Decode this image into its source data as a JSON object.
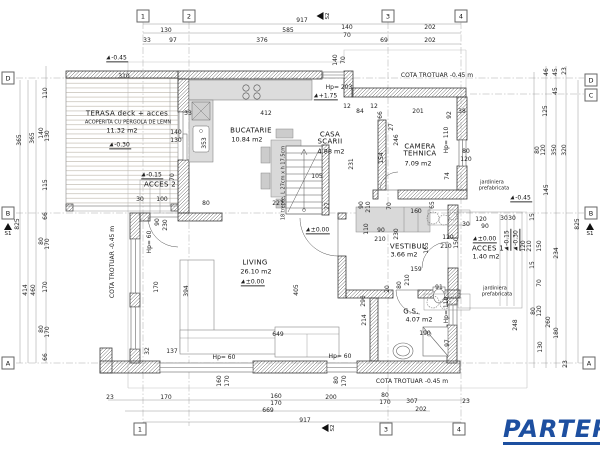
{
  "logo": {
    "text": "PARTER",
    "color": "#1d4fa0"
  },
  "plan": {
    "grid_bubbles": [
      {
        "t": "1",
        "x": 143,
        "y": 16
      },
      {
        "t": "2",
        "x": 189,
        "y": 16
      },
      {
        "t": "3",
        "x": 388,
        "y": 16
      },
      {
        "t": "4",
        "x": 461,
        "y": 16
      },
      {
        "t": "1",
        "x": 140,
        "y": 429
      },
      {
        "t": "3",
        "x": 386,
        "y": 429
      },
      {
        "t": "4",
        "x": 459,
        "y": 429
      },
      {
        "t": "D",
        "x": 8,
        "y": 78
      },
      {
        "t": "B",
        "x": 8,
        "y": 213
      },
      {
        "t": "A",
        "x": 8,
        "y": 363
      },
      {
        "t": "D",
        "x": 591,
        "y": 80
      },
      {
        "t": "C",
        "x": 591,
        "y": 95
      },
      {
        "t": "B",
        "x": 591,
        "y": 213
      },
      {
        "t": "A",
        "x": 589,
        "y": 363
      }
    ],
    "section_markers": [
      {
        "t": "S2",
        "x": 324,
        "y": 16,
        "dir": "left"
      },
      {
        "t": "S2",
        "x": 329,
        "y": 428,
        "dir": "left"
      },
      {
        "t": "S1",
        "x": 8,
        "y": 230,
        "dir": "up"
      },
      {
        "t": "S1",
        "x": 590,
        "y": 230,
        "dir": "up"
      }
    ],
    "rooms": [
      {
        "name": "TERASA deck + acces",
        "nx": 127,
        "ny": 114,
        "sub": "ACOPERITA CU PERGOLA DE LEMN",
        "sx": 128,
        "sy": 123,
        "area": "11.32 m2",
        "ax": 122,
        "ay": 131
      },
      {
        "name": "BUCATARIE",
        "nx": 251,
        "ny": 131,
        "area": "10.84 m2",
        "ax": 247,
        "ay": 140
      },
      {
        "name": "CASA SCARII",
        "nx": 330,
        "ny": 139,
        "nw": 36,
        "area": "4.88 m2",
        "ax": 331,
        "ay": 152
      },
      {
        "name": "CAMERA TEHNICA",
        "nx": 420,
        "ny": 151,
        "nw": 54,
        "area": "7.09 m2",
        "ax": 418,
        "ay": 164
      },
      {
        "name": "VESTIBUL",
        "nx": 408,
        "ny": 247,
        "area": "3.66 m2",
        "ax": 404,
        "ay": 255
      },
      {
        "name": "ACCES 1",
        "nx": 488,
        "ny": 249,
        "area": "1.40 m2",
        "ax": 486,
        "ay": 257
      },
      {
        "name": "ACCES 2",
        "nx": 160,
        "ny": 185
      },
      {
        "name": "LIVING",
        "nx": 255,
        "ny": 263,
        "area": "26.10 m2",
        "ax": 256,
        "ay": 272
      },
      {
        "name": "G.S.",
        "nx": 411,
        "ny": 312,
        "area": "4.07 m2",
        "ax": 419,
        "ay": 320
      }
    ],
    "levels": [
      {
        "t": "-0.45",
        "x": 117,
        "y": 59
      },
      {
        "t": "-0.30",
        "x": 120,
        "y": 146
      },
      {
        "t": "-0.15",
        "x": 152,
        "y": 176
      },
      {
        "t": "+1.75",
        "x": 326,
        "y": 97
      },
      {
        "t": "±0.00",
        "x": 253,
        "y": 283
      },
      {
        "t": "±0.00",
        "x": 318,
        "y": 231
      },
      {
        "t": "±0.00",
        "x": 485,
        "y": 240
      },
      {
        "t": "-0.45",
        "x": 521,
        "y": 199
      },
      {
        "t": "-0.15",
        "x": 508,
        "y": 240,
        "r": 1
      },
      {
        "t": "-0.30",
        "x": 517,
        "y": 240,
        "r": 1
      }
    ],
    "notes": [
      {
        "t": "COTA TROTUAR -0.45 m",
        "x": 437,
        "y": 76
      },
      {
        "t": "COTA TROTUAR -0.45 m",
        "x": 412,
        "y": 382
      },
      {
        "t": "COTA TROTUAR -0.45 m",
        "x": 113,
        "y": 262,
        "r": 1
      },
      {
        "t": "Hp= 203",
        "x": 339,
        "y": 88
      },
      {
        "t": "Hp= 60",
        "x": 224,
        "y": 358
      },
      {
        "t": "Hp= 60",
        "x": 340,
        "y": 357
      },
      {
        "t": "Hp= 60",
        "x": 150,
        "y": 242,
        "r": 1
      },
      {
        "t": "Hp= 110",
        "x": 447,
        "y": 140,
        "r": 1
      },
      {
        "t": "Hp= 110",
        "x": 447,
        "y": 310,
        "r": 1
      },
      {
        "t": "jardiniera",
        "x": 492,
        "y": 183,
        "small": 1
      },
      {
        "t": "prefabricata",
        "x": 494,
        "y": 189,
        "small": 1
      },
      {
        "t": "jardiniera",
        "x": 495,
        "y": 289,
        "small": 1
      },
      {
        "t": "prefabricata",
        "x": 497,
        "y": 295,
        "small": 1
      },
      {
        "t": "18 trepte, L 27cm x h 17.5cm",
        "x": 284,
        "y": 183,
        "r": 1,
        "small": 1
      }
    ],
    "dimensions": [
      {
        "t": "917",
        "x": 302,
        "y": 21
      },
      {
        "t": "130",
        "x": 166,
        "y": 31
      },
      {
        "t": "585",
        "x": 288,
        "y": 31
      },
      {
        "t": "140",
        "x": 347,
        "y": 28
      },
      {
        "t": "70",
        "x": 347,
        "y": 36
      },
      {
        "t": "202",
        "x": 430,
        "y": 28
      },
      {
        "t": "33",
        "x": 147,
        "y": 41
      },
      {
        "t": "97",
        "x": 173,
        "y": 41
      },
      {
        "t": "376",
        "x": 262,
        "y": 41
      },
      {
        "t": "69",
        "x": 384,
        "y": 41
      },
      {
        "t": "202",
        "x": 430,
        "y": 41
      },
      {
        "t": "140",
        "x": 336,
        "y": 60,
        "r": 1
      },
      {
        "t": "70",
        "x": 344,
        "y": 60,
        "r": 1
      },
      {
        "t": "310",
        "x": 124,
        "y": 77
      },
      {
        "t": "110",
        "x": 46,
        "y": 93,
        "r": 1
      },
      {
        "t": "33",
        "x": 188,
        "y": 114
      },
      {
        "t": "412",
        "x": 266,
        "y": 114
      },
      {
        "t": "84",
        "x": 360,
        "y": 112
      },
      {
        "t": "12",
        "x": 347,
        "y": 107
      },
      {
        "t": "12",
        "x": 374,
        "y": 107
      },
      {
        "t": "66",
        "x": 381,
        "y": 115,
        "r": 1
      },
      {
        "t": "201",
        "x": 418,
        "y": 112
      },
      {
        "t": "92",
        "x": 450,
        "y": 115,
        "r": 1
      },
      {
        "t": "38",
        "x": 462,
        "y": 112
      },
      {
        "t": "27",
        "x": 392,
        "y": 127,
        "r": 1
      },
      {
        "t": "246",
        "x": 397,
        "y": 140,
        "r": 1
      },
      {
        "t": "154",
        "x": 382,
        "y": 158,
        "r": 1
      },
      {
        "t": "74",
        "x": 448,
        "y": 176,
        "r": 1
      },
      {
        "t": "80",
        "x": 466,
        "y": 152
      },
      {
        "t": "120",
        "x": 466,
        "y": 160
      },
      {
        "t": "140",
        "x": 176,
        "y": 133
      },
      {
        "t": "130",
        "x": 176,
        "y": 141
      },
      {
        "t": "353",
        "x": 205,
        "y": 143,
        "r": 1
      },
      {
        "t": "365",
        "x": 20,
        "y": 140,
        "r": 1
      },
      {
        "t": "365",
        "x": 33,
        "y": 138,
        "r": 1
      },
      {
        "t": "140",
        "x": 42,
        "y": 133,
        "r": 1
      },
      {
        "t": "130",
        "x": 48,
        "y": 136,
        "r": 1
      },
      {
        "t": "115",
        "x": 46,
        "y": 185,
        "r": 1
      },
      {
        "t": "66",
        "x": 46,
        "y": 216,
        "r": 1
      },
      {
        "t": "825",
        "x": 18,
        "y": 224,
        "r": 1
      },
      {
        "t": "80",
        "x": 42,
        "y": 241,
        "r": 1
      },
      {
        "t": "170",
        "x": 48,
        "y": 244,
        "r": 1
      },
      {
        "t": "170",
        "x": 46,
        "y": 287,
        "r": 1
      },
      {
        "t": "414",
        "x": 26,
        "y": 290,
        "r": 1
      },
      {
        "t": "460",
        "x": 34,
        "y": 290,
        "r": 1
      },
      {
        "t": "80",
        "x": 42,
        "y": 329,
        "r": 1
      },
      {
        "t": "170",
        "x": 48,
        "y": 332,
        "r": 1
      },
      {
        "t": "66",
        "x": 46,
        "y": 357,
        "r": 1
      },
      {
        "t": "46",
        "x": 547,
        "y": 72,
        "r": 1
      },
      {
        "t": "45",
        "x": 556,
        "y": 72,
        "r": 1
      },
      {
        "t": "23",
        "x": 565,
        "y": 71,
        "r": 1
      },
      {
        "t": "45",
        "x": 556,
        "y": 91,
        "r": 1
      },
      {
        "t": "125",
        "x": 546,
        "y": 111,
        "r": 1
      },
      {
        "t": "80",
        "x": 538,
        "y": 150,
        "r": 1
      },
      {
        "t": "120",
        "x": 544,
        "y": 150,
        "r": 1
      },
      {
        "t": "350",
        "x": 555,
        "y": 150,
        "r": 1
      },
      {
        "t": "320",
        "x": 565,
        "y": 150,
        "r": 1
      },
      {
        "t": "145",
        "x": 547,
        "y": 190,
        "r": 1
      },
      {
        "t": "15",
        "x": 533,
        "y": 217,
        "r": 1
      },
      {
        "t": "825",
        "x": 578,
        "y": 224,
        "r": 1
      },
      {
        "t": "120",
        "x": 524,
        "y": 246,
        "r": 1
      },
      {
        "t": "210",
        "x": 530,
        "y": 246,
        "r": 1
      },
      {
        "t": "150",
        "x": 540,
        "y": 246,
        "r": 1
      },
      {
        "t": "234",
        "x": 557,
        "y": 253,
        "r": 1
      },
      {
        "t": "15",
        "x": 533,
        "y": 265,
        "r": 1
      },
      {
        "t": "70",
        "x": 540,
        "y": 283,
        "r": 1
      },
      {
        "t": "80",
        "x": 534,
        "y": 311,
        "r": 1
      },
      {
        "t": "120",
        "x": 540,
        "y": 311,
        "r": 1
      },
      {
        "t": "260",
        "x": 549,
        "y": 322,
        "r": 1
      },
      {
        "t": "180",
        "x": 557,
        "y": 333,
        "r": 1
      },
      {
        "t": "130",
        "x": 541,
        "y": 347,
        "r": 1
      },
      {
        "t": "23",
        "x": 566,
        "y": 364,
        "r": 1
      },
      {
        "t": "248",
        "x": 516,
        "y": 325,
        "r": 1
      },
      {
        "t": "100",
        "x": 162,
        "y": 200
      },
      {
        "t": "30",
        "x": 140,
        "y": 200
      },
      {
        "t": "80",
        "x": 206,
        "y": 204
      },
      {
        "t": "227",
        "x": 278,
        "y": 204
      },
      {
        "t": "90",
        "x": 158,
        "y": 222,
        "r": 1
      },
      {
        "t": "230",
        "x": 166,
        "y": 225,
        "r": 1
      },
      {
        "t": "70",
        "x": 173,
        "y": 177,
        "r": 1
      },
      {
        "t": "105",
        "x": 317,
        "y": 177
      },
      {
        "t": "27",
        "x": 328,
        "y": 206,
        "r": 1
      },
      {
        "t": "231",
        "x": 352,
        "y": 164,
        "r": 1
      },
      {
        "t": "90",
        "x": 362,
        "y": 205,
        "r": 1
      },
      {
        "t": "210",
        "x": 369,
        "y": 207,
        "r": 1
      },
      {
        "t": "110",
        "x": 367,
        "y": 229,
        "r": 1
      },
      {
        "t": "160",
        "x": 416,
        "y": 212
      },
      {
        "t": "65",
        "x": 433,
        "y": 205,
        "r": 1
      },
      {
        "t": "70",
        "x": 390,
        "y": 206,
        "r": 1
      },
      {
        "t": "90",
        "x": 381,
        "y": 231
      },
      {
        "t": "210",
        "x": 380,
        "y": 240
      },
      {
        "t": "230",
        "x": 397,
        "y": 234,
        "r": 1
      },
      {
        "t": "165",
        "x": 427,
        "y": 248,
        "r": 1
      },
      {
        "t": "120",
        "x": 448,
        "y": 238
      },
      {
        "t": "210",
        "x": 446,
        "y": 247
      },
      {
        "t": "150",
        "x": 457,
        "y": 243,
        "r": 1
      },
      {
        "t": "120",
        "x": 481,
        "y": 220
      },
      {
        "t": "90",
        "x": 485,
        "y": 227
      },
      {
        "t": "30",
        "x": 466,
        "y": 225
      },
      {
        "t": "30",
        "x": 504,
        "y": 219
      },
      {
        "t": "30",
        "x": 512,
        "y": 219
      },
      {
        "t": "159",
        "x": 416,
        "y": 270
      },
      {
        "t": "210",
        "x": 408,
        "y": 280,
        "r": 1
      },
      {
        "t": "80",
        "x": 400,
        "y": 285,
        "r": 1
      },
      {
        "t": "20",
        "x": 388,
        "y": 289,
        "r": 1
      },
      {
        "t": "91",
        "x": 439,
        "y": 288
      },
      {
        "t": "190",
        "x": 425,
        "y": 334
      },
      {
        "t": "97",
        "x": 448,
        "y": 343,
        "r": 1
      },
      {
        "t": "296",
        "x": 364,
        "y": 301,
        "r": 1
      },
      {
        "t": "214",
        "x": 365,
        "y": 320,
        "r": 1
      },
      {
        "t": "394",
        "x": 187,
        "y": 291,
        "r": 1
      },
      {
        "t": "170",
        "x": 157,
        "y": 287,
        "r": 1
      },
      {
        "t": "405",
        "x": 297,
        "y": 290,
        "r": 1
      },
      {
        "t": "649",
        "x": 278,
        "y": 335
      },
      {
        "t": "137",
        "x": 172,
        "y": 352
      },
      {
        "t": "32",
        "x": 148,
        "y": 351,
        "r": 1
      },
      {
        "t": "160",
        "x": 220,
        "y": 381,
        "r": 1
      },
      {
        "t": "170",
        "x": 228,
        "y": 381,
        "r": 1
      },
      {
        "t": "80",
        "x": 337,
        "y": 380,
        "r": 1
      },
      {
        "t": "170",
        "x": 345,
        "y": 381,
        "r": 1
      },
      {
        "t": "23",
        "x": 110,
        "y": 398
      },
      {
        "t": "170",
        "x": 166,
        "y": 398
      },
      {
        "t": "160",
        "x": 276,
        "y": 397
      },
      {
        "t": "170",
        "x": 276,
        "y": 404
      },
      {
        "t": "200",
        "x": 331,
        "y": 398
      },
      {
        "t": "80",
        "x": 385,
        "y": 396
      },
      {
        "t": "170",
        "x": 385,
        "y": 403
      },
      {
        "t": "669",
        "x": 268,
        "y": 411
      },
      {
        "t": "917",
        "x": 305,
        "y": 421
      },
      {
        "t": "307",
        "x": 412,
        "y": 402
      },
      {
        "t": "202",
        "x": 421,
        "y": 410
      },
      {
        "t": "23",
        "x": 466,
        "y": 402
      }
    ]
  }
}
